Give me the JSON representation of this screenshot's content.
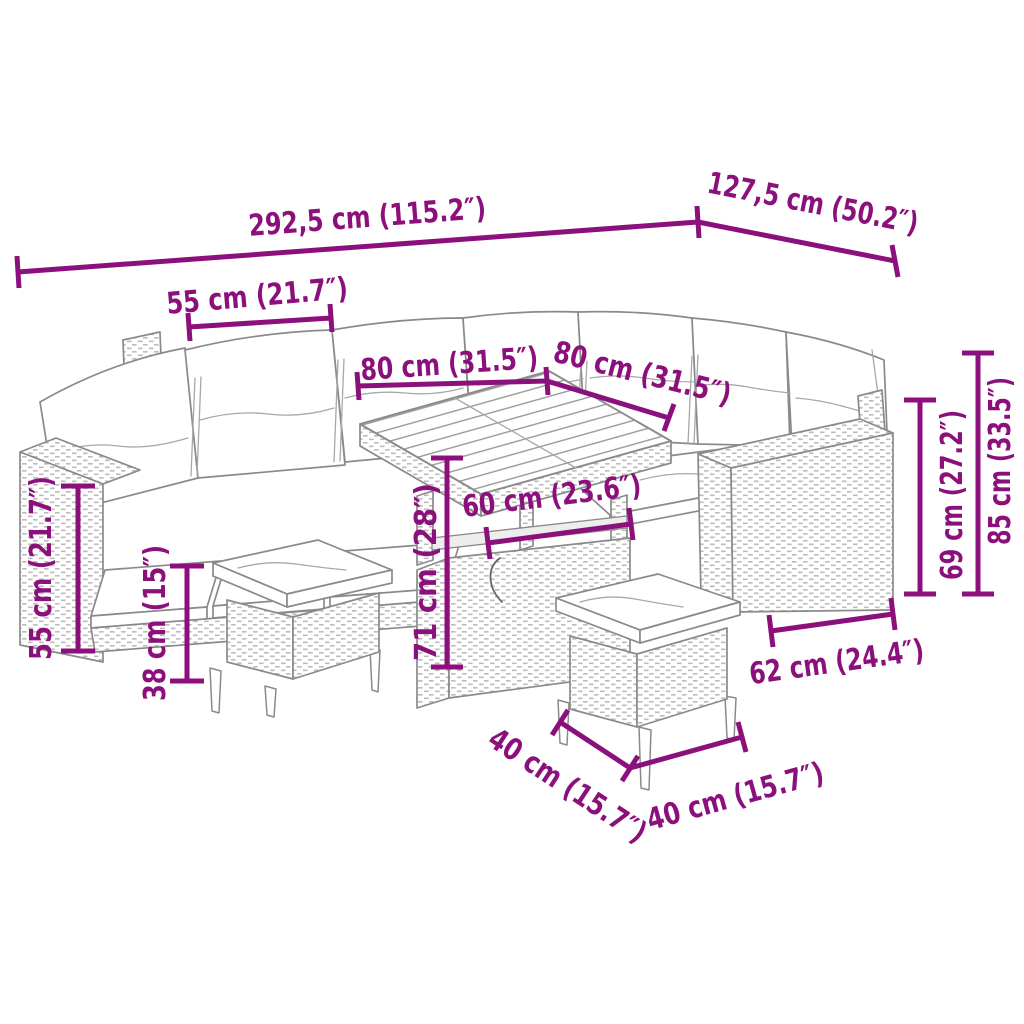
{
  "diagram": {
    "type": "product-dimension-diagram",
    "subject": "poly rattan garden lounge set with corner sofa, back cushions, dining table and two stools",
    "accent_color": "#8C107C",
    "outline_color": "#8A8A8A",
    "background_color": "#FFFFFF"
  },
  "dimensions": {
    "overall_width": "292,5 cm (115.2″)",
    "overall_depth": "127,5 cm (50.2″)",
    "seat_section_width": "55 cm (21.7″)",
    "table_width": "80 cm (31.5″)",
    "table_depth": "80 cm (31.5″)",
    "table_clearance_width": "60 cm (23.6″)",
    "table_height": "71 cm (28″)",
    "seat_height": "55 cm (21.7″)",
    "stool_height": "38 cm (15″)",
    "stool_width": "40 cm (15.7″)",
    "stool_depth": "40 cm (15.7″)",
    "armrest_section_depth": "62 cm (24.4″)",
    "backrest_height": "69 cm (27.2″)",
    "overall_height": "85 cm (33.5″)"
  }
}
